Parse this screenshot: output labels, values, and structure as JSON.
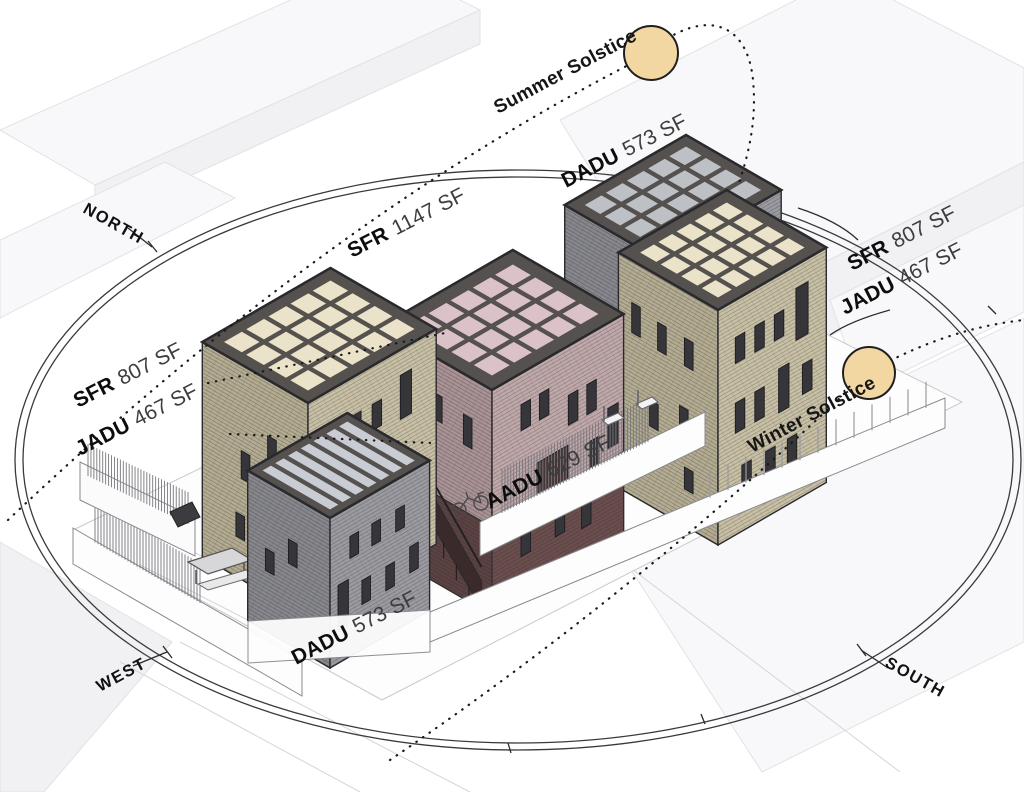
{
  "diagram": {
    "compass": {
      "north": "NORTH",
      "west": "WEST",
      "south": "SOUTH"
    },
    "sun": {
      "summer": "Summer Solstice",
      "winter": "Winter Solstice"
    },
    "area_labels": {
      "dadu_top": {
        "key": "DADU",
        "value": "573 SF"
      },
      "sfr_main": {
        "key": "SFR",
        "value": "1147 SF"
      },
      "sfr_right": {
        "key": "SFR",
        "value": "807 SF"
      },
      "jadu_right": {
        "key": "JADU",
        "value": "467 SF"
      },
      "sfr_left": {
        "key": "SFR",
        "value": "807 SF"
      },
      "jadu_left": {
        "key": "JADU",
        "value": "467 SF"
      },
      "aadu": {
        "key": "AADU",
        "value": "629 SF"
      },
      "dadu_bottom": {
        "key": "DADU",
        "value": "573 SF"
      }
    },
    "colors": {
      "sun": "#f2d7a2",
      "sun_stroke": "#1f1f1f",
      "tan_wall": "#c8c1a6",
      "tan_wall_dark": "#b4ad93",
      "tan_roof": "#ebe3c9",
      "pink_wall": "#c0a9ab",
      "pink_wall_dark": "#aa9396",
      "pink_roof": "#dbc2c8",
      "maroon_base": "#6b4f4f",
      "maroon_base_dark": "#5c4343",
      "gray_wall": "#9b9ca2",
      "gray_wall_dark": "#87888e",
      "gray_roof": "#bdc0c5",
      "glass_roof": "#c9ccd2",
      "roof_joint": "#55514e",
      "window": "#35353a",
      "outline": "#2a2a2e"
    }
  }
}
